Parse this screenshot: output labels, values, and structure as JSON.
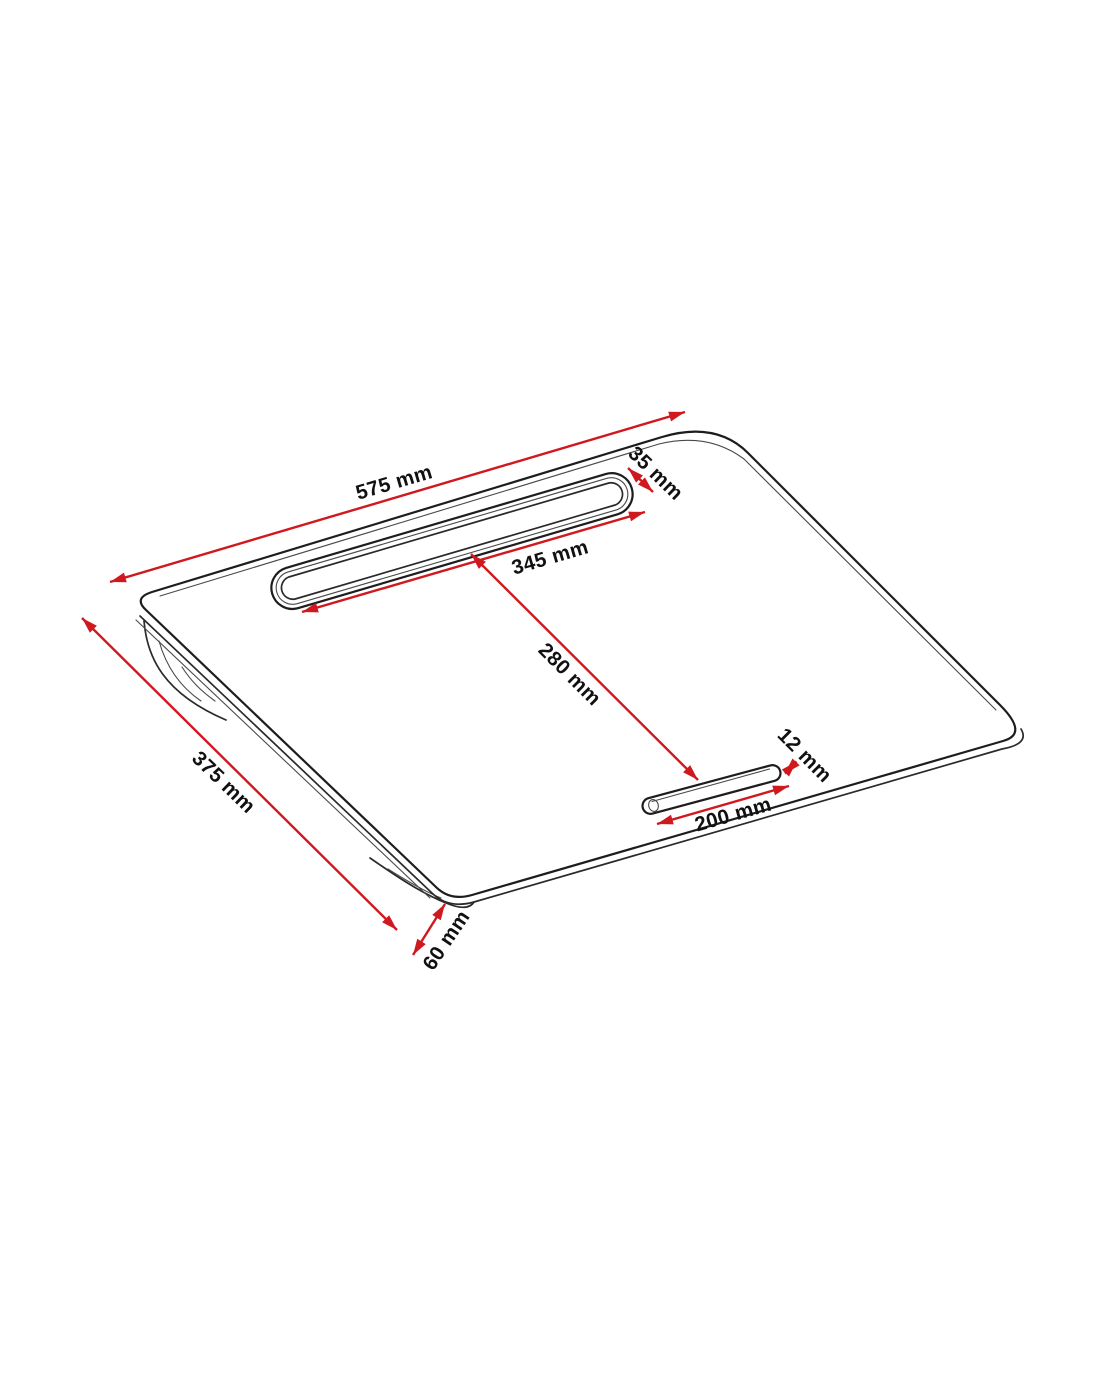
{
  "image": {
    "description": "Technical dimension drawing of a lap desk (cushioned tablet lap tray) in isometric view",
    "background": "#ffffff"
  },
  "colors": {
    "dimension_red": "#d0181f",
    "line_black": "#1d1d1d",
    "label_text": "#111111"
  },
  "dimensions": {
    "top_width": {
      "label": "575 mm",
      "value_mm": 575,
      "measures": "overall width along top edge"
    },
    "slot_length": {
      "label": "345 mm",
      "value_mm": 345,
      "measures": "tablet slot length"
    },
    "slot_width": {
      "label": "35 mm",
      "value_mm": 35,
      "measures": "tablet slot width"
    },
    "slot_to_groove": {
      "label": "280 mm",
      "value_mm": 280,
      "measures": "distance from tablet slot to pen groove"
    },
    "groove_length": {
      "label": "200 mm",
      "value_mm": 200,
      "measures": "pen groove length"
    },
    "groove_width": {
      "label": "12 mm",
      "value_mm": 12,
      "measures": "pen groove width"
    },
    "side_depth": {
      "label": "375 mm",
      "value_mm": 375,
      "measures": "overall depth along left edge"
    },
    "cushion_height": {
      "label": "60 mm",
      "value_mm": 60,
      "measures": "cushion height at corner"
    }
  }
}
